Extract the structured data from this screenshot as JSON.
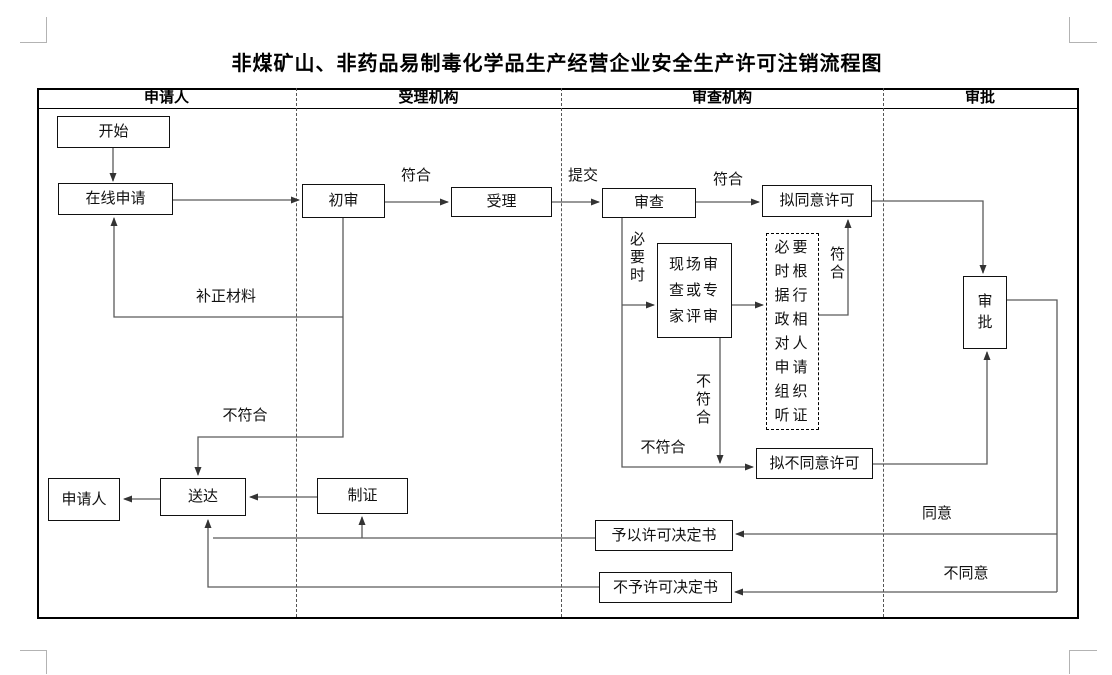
{
  "title": "非煤矿山、非药品易制毒化学品生产经营企业安全生产许可注销流程图",
  "lanes": {
    "applicant": "申请人",
    "accepting_agency": "受理机构",
    "review_agency": "审查机构",
    "approval": "审批"
  },
  "nodes": {
    "start": "开始",
    "online_apply": "在线申请",
    "initial_review": "初审",
    "accept": "受理",
    "review": "审查",
    "draft_approve": "拟同意许可",
    "onsite_review": "现场审\n查或专\n家评审",
    "hearing": "必要\n时根\n据行\n政相\n对人\n申请\n组织\n听证",
    "draft_deny": "拟不同意许可",
    "approval": "审\n批",
    "grant_decision": "予以许可决定书",
    "deny_decision": "不予许可决定书",
    "make_certificate": "制证",
    "deliver": "送达",
    "applicant_end": "申请人"
  },
  "edge_labels": {
    "conform_initial": "符合",
    "submit": "提交",
    "conform_review": "符合",
    "supplement_materials": "补正材料",
    "not_conform_initial": "不符合",
    "necessary": "必\n要\n时",
    "not_conform_onsite": "不\n符\n合",
    "conform_hearing": "符\n合",
    "not_conform_review": "不符合",
    "agree": "同意",
    "disagree": "不同意"
  }
}
